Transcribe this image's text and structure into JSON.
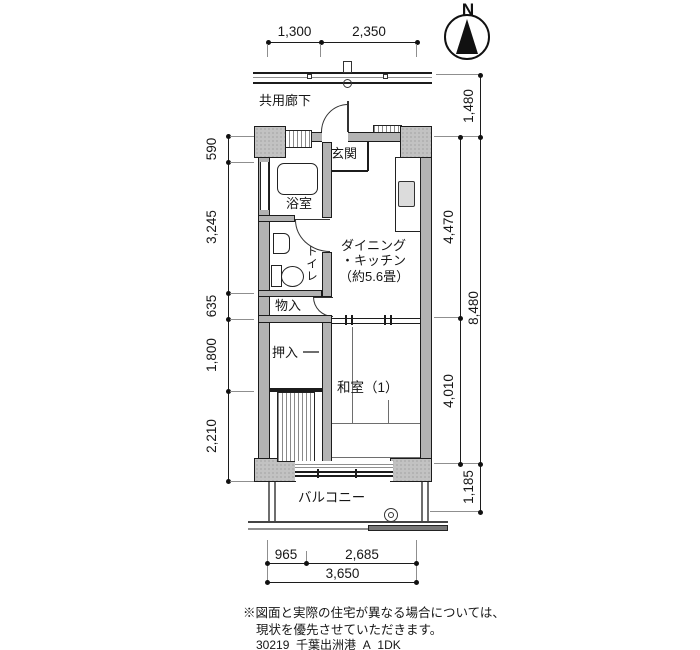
{
  "compass": {
    "north_label": "N"
  },
  "plan": {
    "corridor_label": "共用廊下",
    "entrance_label": "玄関",
    "bathroom_label": "浴室",
    "toilet_label": "トイレ",
    "storage_label": "物入",
    "closet_label": "押入",
    "dk_label_line1": "ダイニング",
    "dk_label_line2": "・キッチン",
    "dk_label_line3": "（約5.6畳）",
    "japanese_room_label": "和室（1）",
    "balcony_label": "バルコニー"
  },
  "dimensions": {
    "top": [
      "1,300",
      "2,350"
    ],
    "left": [
      "590",
      "3,245",
      "635",
      "1,800",
      "2,210"
    ],
    "right_inner": [
      "4,470",
      "4,010"
    ],
    "right_outer": [
      "1,480",
      "8,480",
      "1,185"
    ],
    "bottom_upper": [
      "965",
      "2,685"
    ],
    "bottom_lower": "3,650"
  },
  "footer": {
    "note_line1": "※図面と実際の住宅が異なる場合については、",
    "note_line2": "現状を優先させていただきます。",
    "plan_code": "30219_千葉出洲港_A_1DK"
  },
  "colors": {
    "wall": "#b3b3b3",
    "pillar": "#c2c2c2",
    "line": "#1c1c1c",
    "sink_fill": "#dcdcdc"
  }
}
